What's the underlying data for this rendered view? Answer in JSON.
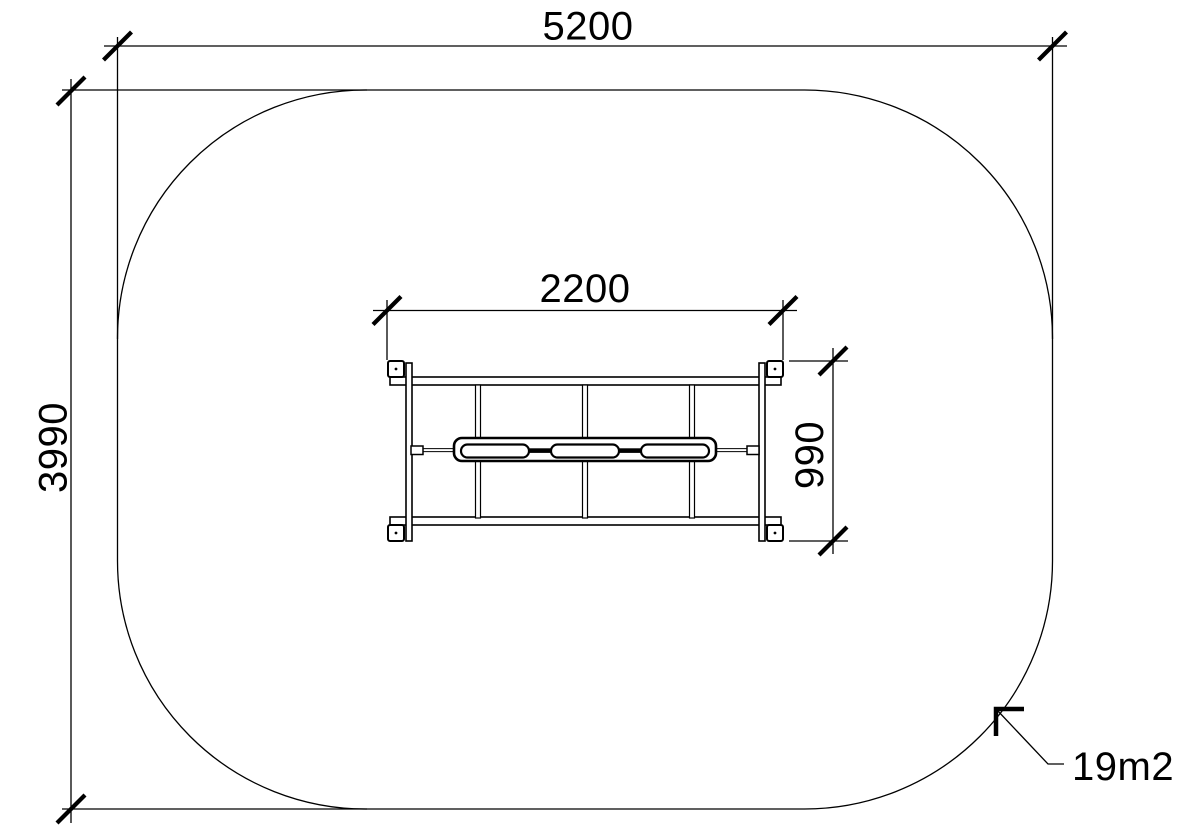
{
  "drawing": {
    "title": "Playground equipment plan view with safety surfacing area",
    "dim_area_width": "5200",
    "dim_area_height": "3990",
    "dim_equipment_width": "2200",
    "dim_equipment_height": "990",
    "surface_area_label": "19m2",
    "colors": {
      "line": "#000000",
      "background": "#ffffff"
    }
  }
}
